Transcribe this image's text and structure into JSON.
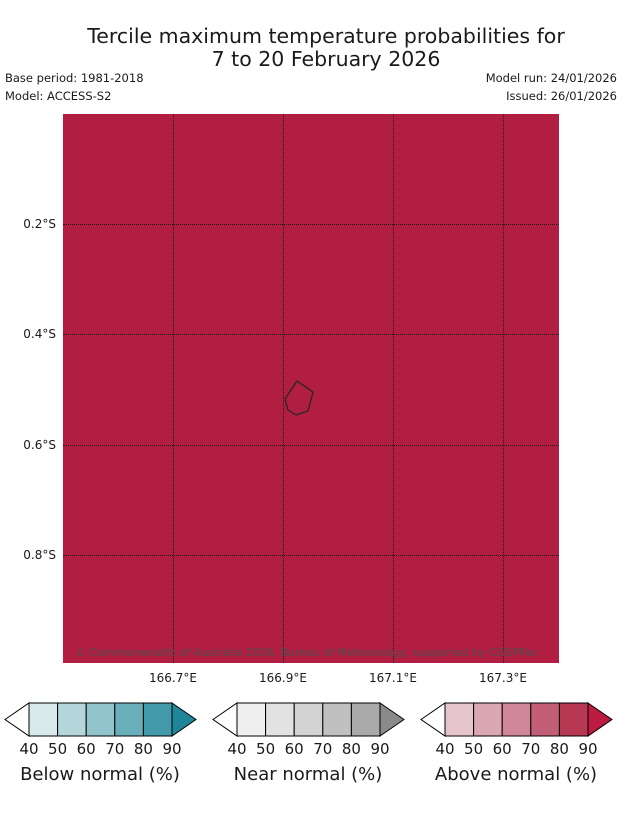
{
  "title": {
    "line1": "Tercile maximum temperature probabilities for",
    "line2": "7 to 20 February 2026"
  },
  "meta": {
    "base_period": "Base period: 1981-2018",
    "model": "Model: ACCESS-S2",
    "model_run": "Model run: 24/01/2026",
    "issued": "Issued: 26/01/2026"
  },
  "map": {
    "fill_color": "#b21e41",
    "island_outline_color": "#262626",
    "gridline_color": "#1a1a1a",
    "y_tick_labels": [
      "0.2°S",
      "0.4°S",
      "0.6°S",
      "0.8°S"
    ],
    "x_tick_labels": [
      "166.7°E",
      "166.9°E",
      "167.1°E",
      "167.3°E"
    ],
    "copyright": "© Commonwealth of Australia 2026, Bureau of Meteorology, supported by COSPPac"
  },
  "legend": {
    "tick_labels": [
      "40",
      "50",
      "60",
      "70",
      "80",
      "90"
    ],
    "bars": [
      {
        "label": "Below normal (%)",
        "segment_colors": [
          "#d9eaec",
          "#b5d6da",
          "#90c3ca",
          "#69afba",
          "#4299a9"
        ],
        "arrow_color": "#1f8699",
        "left_arrow_color": "#ffffff"
      },
      {
        "label": "Near normal (%)",
        "segment_colors": [
          "#efefef",
          "#e2e2e2",
          "#d3d3d3",
          "#c0c0c0",
          "#aaaaaa"
        ],
        "arrow_color": "#8a8a8a",
        "left_arrow_color": "#ffffff"
      },
      {
        "label": "Above normal (%)",
        "segment_colors": [
          "#e6c4cd",
          "#dba7b3",
          "#d08797",
          "#c25f76",
          "#b63853"
        ],
        "arrow_color": "#bb1a41",
        "left_arrow_color": "#ffffff"
      }
    ]
  },
  "chart_data": {
    "type": "map",
    "title": "Tercile maximum temperature probabilities for 7 to 20 February 2026",
    "region": "Nauru",
    "base_period": "1981-2018",
    "model": "ACCESS-S2",
    "model_run_date": "24/01/2026",
    "issued_date": "26/01/2026",
    "lon_ticks_E": [
      166.7,
      166.9,
      167.1,
      167.3
    ],
    "lat_ticks_S": [
      0.2,
      0.4,
      0.6,
      0.8
    ],
    "grid": "dotted",
    "depicted_field": "Tercile maximum temperature probability",
    "map_value": "Entire shown domain shaded in the Above normal >90% class (crimson)",
    "colorbar_scale_percent": [
      40,
      50,
      60,
      70,
      80,
      90
    ],
    "categories": [
      "Below normal (%)",
      "Near normal (%)",
      "Above normal (%)"
    ]
  }
}
